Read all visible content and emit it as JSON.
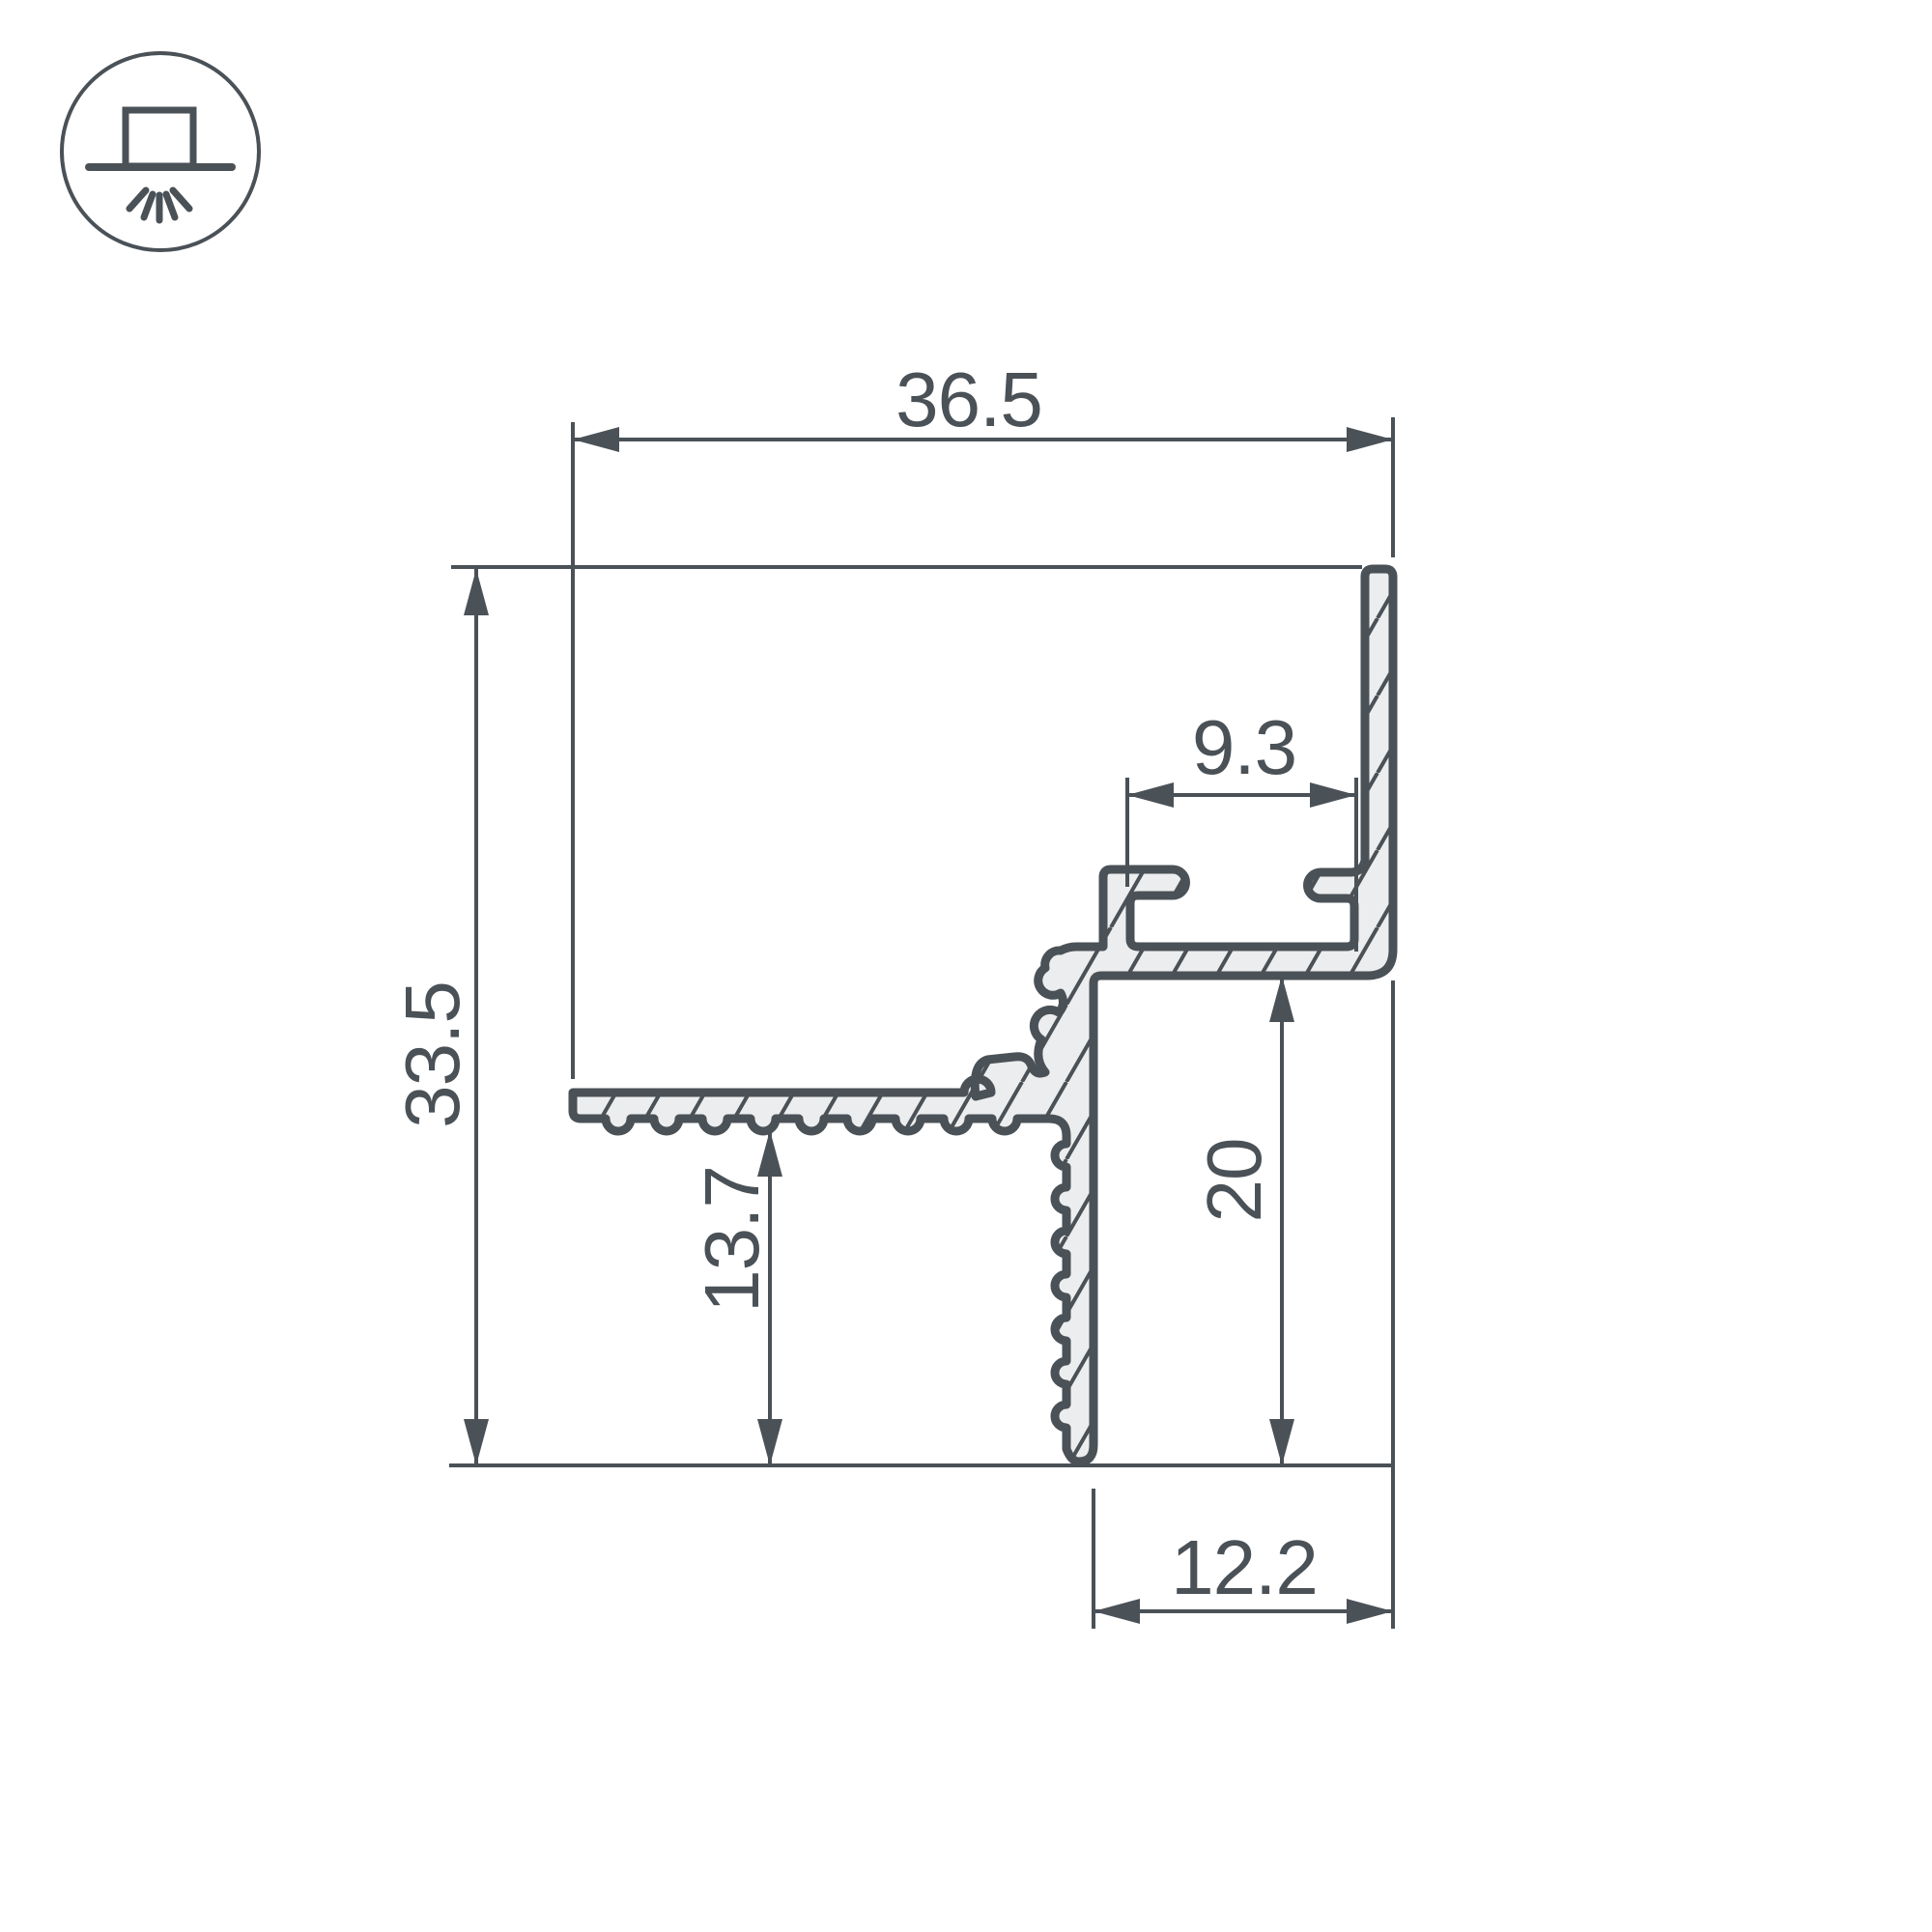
{
  "drawing": {
    "colors": {
      "line": "#4a5157",
      "fill": "#ecedee",
      "background": "#ffffff"
    },
    "icon": "recessed-ceiling-light",
    "dims": {
      "top_width": "36.5",
      "left_height": "33.5",
      "slot_width": "9.3",
      "flange_offset": "13.7",
      "inner_height": "20",
      "bottom_width": "12.2"
    }
  }
}
